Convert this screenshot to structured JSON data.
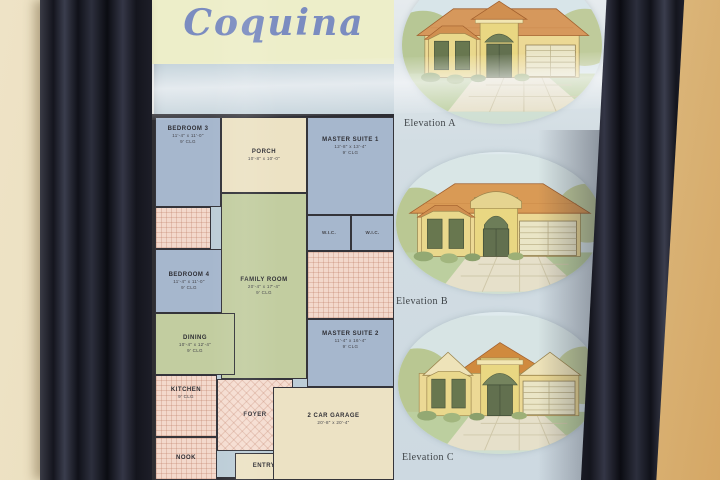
{
  "poster": {
    "title": "Coquina",
    "plan": {
      "rooms": {
        "bedroom3": {
          "name": "BEDROOM 3",
          "dims": "11'-4\" x 11'-0\"",
          "clg": "9' CLG"
        },
        "porch": {
          "name": "PORCH",
          "dims": "10'-8\" x 10'-0\""
        },
        "master_suite1": {
          "name": "MASTER SUITE 1",
          "dims": "12'-8\" x 13'-4\"",
          "clg": "9' CLG"
        },
        "bedroom4": {
          "name": "BEDROOM 4",
          "dims": "11'-4\" x 11'-0\"",
          "clg": "9' CLG"
        },
        "family_room": {
          "name": "FAMILY ROOM",
          "dims": "20'-4\" x 17'-4\"",
          "clg": "9' CLG"
        },
        "wic1": {
          "name": "W.I.C."
        },
        "wic2": {
          "name": "W.I.C."
        },
        "dining": {
          "name": "DINING",
          "dims": "10'-4\" x 12'-4\"",
          "clg": "9' CLG"
        },
        "master_suite2": {
          "name": "MASTER SUITE 2",
          "dims": "11'-4\" x 16'-4\"",
          "clg": "9' CLG"
        },
        "kitchen": {
          "name": "KITCHEN",
          "clg": "9' CLG"
        },
        "foyer": {
          "name": "FOYER"
        },
        "nook": {
          "name": "NOOK"
        },
        "entry": {
          "name": "ENTRY"
        },
        "garage": {
          "name": "2 CAR GARAGE",
          "dims": "20'-8\" x 20'-4\""
        }
      }
    },
    "elevations": [
      {
        "label": "Elevation A"
      },
      {
        "label": "Elevation B"
      },
      {
        "label": "Elevation C"
      }
    ]
  },
  "colors": {
    "frame": "#191b26",
    "wall_left": "#eee3c6",
    "wall_right": "#d5a765",
    "title_text": "#7b8cc0",
    "title_band": "#edeec9",
    "plan_background": "#bccdd7",
    "room_blue": "#a6b7cd",
    "room_green": "#c2cda0",
    "room_cream": "#ece2c4",
    "room_pink": "#f3d9cc",
    "roof_terracotta": "#d6985c",
    "house_wall_yellow": "#ecd995"
  }
}
